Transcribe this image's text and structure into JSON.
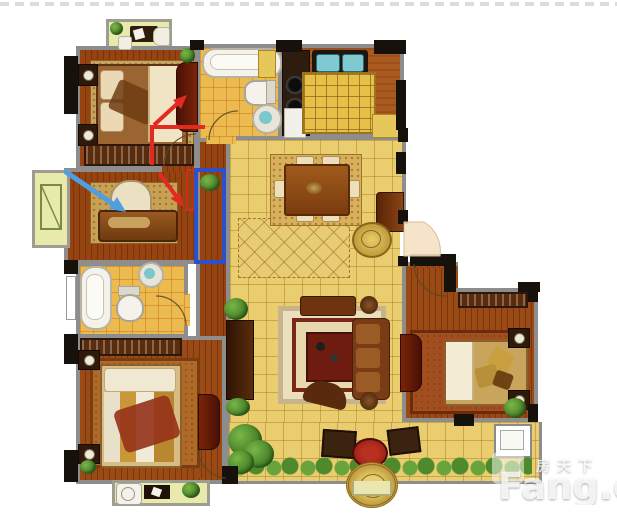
{
  "canvas": {
    "width": 617,
    "height": 521
  },
  "watermark": {
    "site_name_cn": "房天下",
    "site_name_en": "Fang.c",
    "text_color": "#ffffff"
  },
  "colors": {
    "annotation_red": "#e32a20",
    "annotation_blue_arrow": "#4f9fe0",
    "highlight_blue_rect": "#2b50c8",
    "wall_gray": "#8d8d8d",
    "wall_pier_black": "#17110c",
    "wood_floor": "#964312",
    "gold_tile": "#e9cd6e",
    "balcony_yellow": "#e8eaac"
  },
  "annotations": {
    "red_corner_line": {
      "d": "M152,163 L152,127 L203,127",
      "color": "#e32a20"
    },
    "red_arrow_up": {
      "shaft": "M154,125 L178,103",
      "head": "M187,95 L181,109 L173,100 Z",
      "color": "#e32a20"
    },
    "red_arrow_down": {
      "shaft": "M159,173 L176,196",
      "head": "M184,207 L171,199 L180,192 Z",
      "color": "#e32a20"
    },
    "red_thin_rect": {
      "x": 187,
      "y": 170,
      "w": 7,
      "h": 40,
      "color": "#e32a20"
    },
    "blue_arrow": {
      "shaft": "M66,172 L113,204",
      "head": "M126,212 L109,209 L117,197 Z",
      "color": "#4f9fe0"
    },
    "blue_rect_highlight": {
      "x": 196,
      "y": 170,
      "w": 28,
      "h": 92,
      "color": "#2b50c8"
    }
  }
}
